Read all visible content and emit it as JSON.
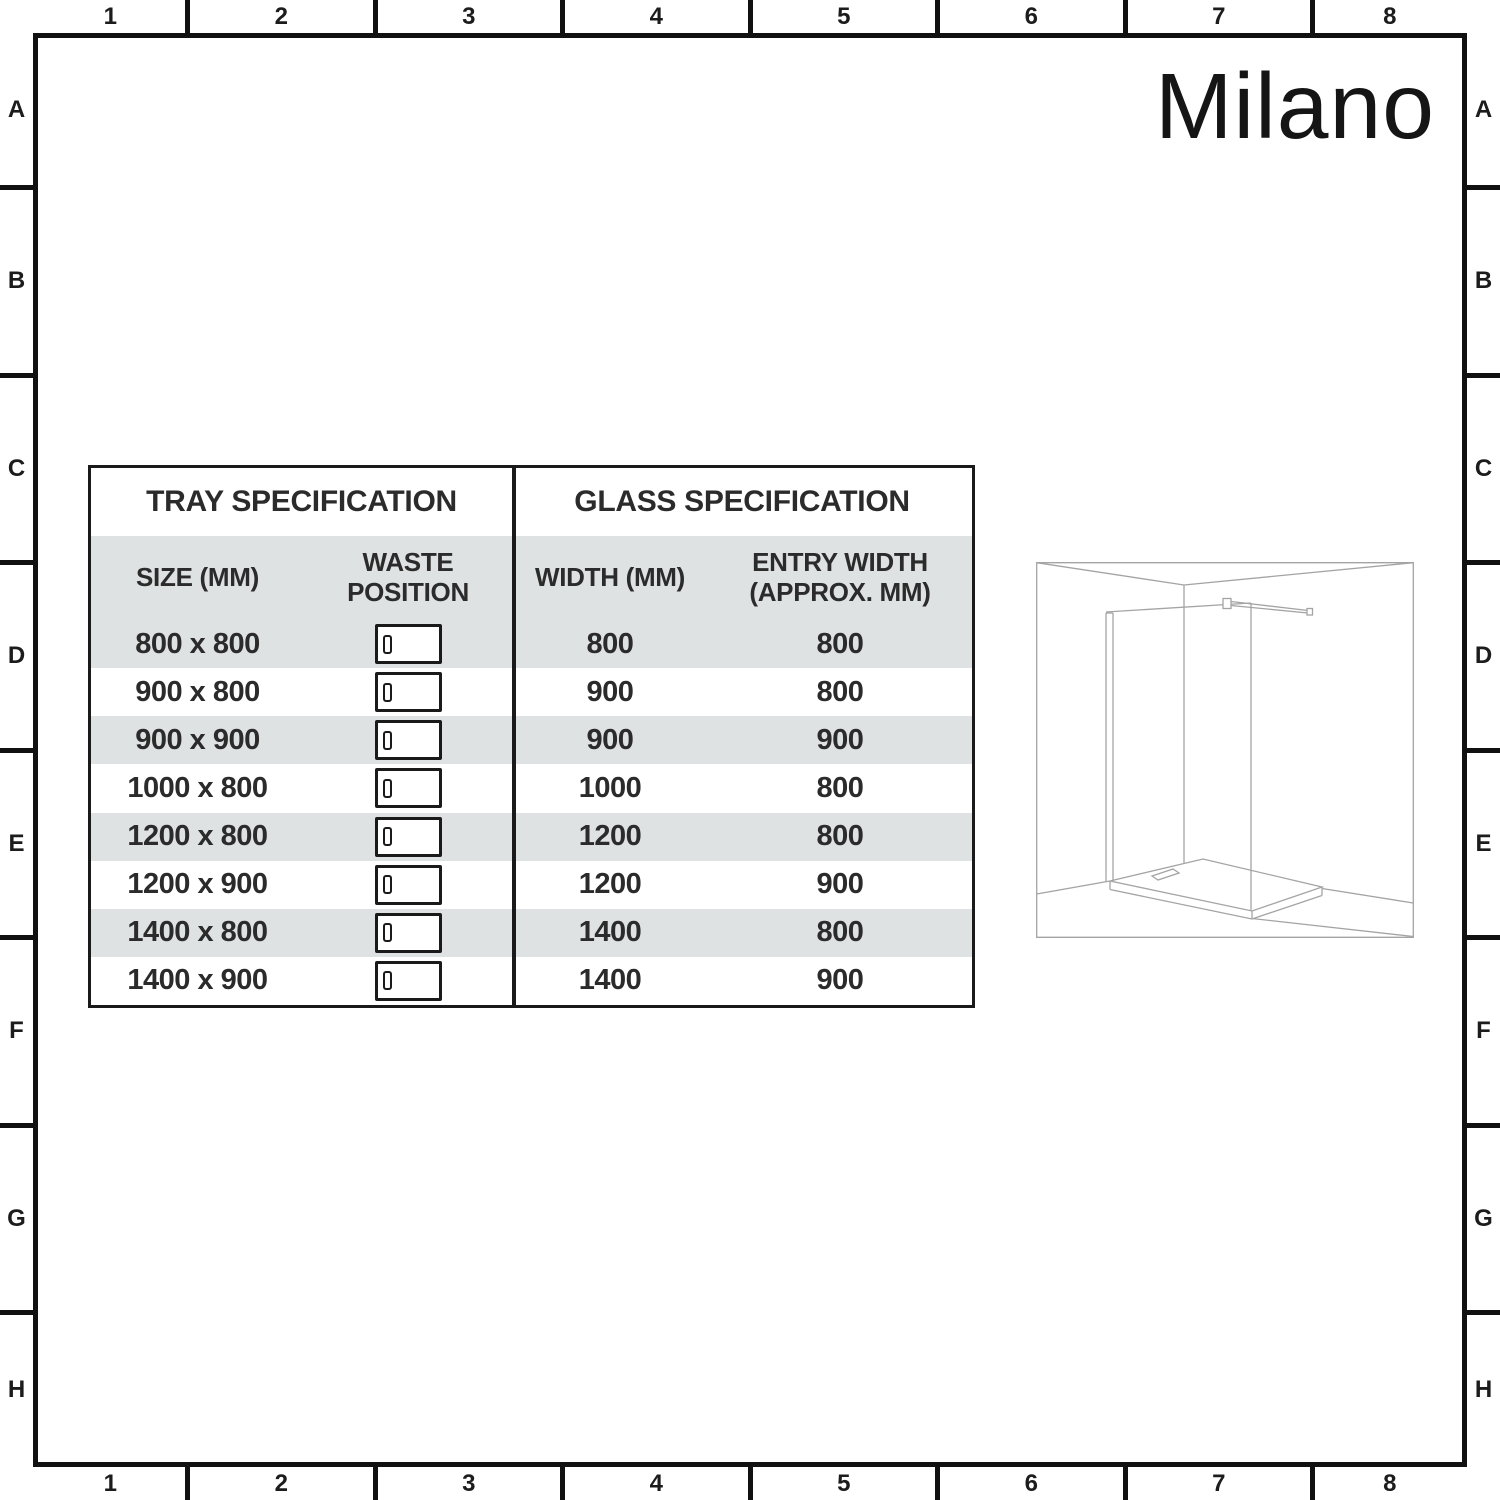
{
  "brand": {
    "logo": "Milano"
  },
  "border": {
    "columns": [
      "1",
      "2",
      "3",
      "4",
      "5",
      "6",
      "7",
      "8"
    ],
    "rows": [
      "A",
      "B",
      "C",
      "D",
      "E",
      "F",
      "G",
      "H"
    ]
  },
  "tables": {
    "tray": {
      "title": "TRAY SPECIFICATION",
      "col_size": "SIZE (MM)",
      "col_waste": "WASTE POSITION",
      "rows": [
        {
          "size": "800 x 800",
          "waste_icon": "tray-waste-position-icon"
        },
        {
          "size": "900 x 800",
          "waste_icon": "tray-waste-position-icon"
        },
        {
          "size": "900 x 900",
          "waste_icon": "tray-waste-position-icon"
        },
        {
          "size": "1000 x 800",
          "waste_icon": "tray-waste-position-icon"
        },
        {
          "size": "1200 x 800",
          "waste_icon": "tray-waste-position-icon"
        },
        {
          "size": "1200 x 900",
          "waste_icon": "tray-waste-position-icon"
        },
        {
          "size": "1400 x 800",
          "waste_icon": "tray-waste-position-icon"
        },
        {
          "size": "1400 x 900",
          "waste_icon": "tray-waste-position-icon"
        }
      ]
    },
    "glass": {
      "title": "GLASS SPECIFICATION",
      "col_width": "WIDTH (MM)",
      "col_entry": "ENTRY WIDTH (APPROX. MM)",
      "rows": [
        {
          "width": "800",
          "entry": "800"
        },
        {
          "width": "900",
          "entry": "800"
        },
        {
          "width": "900",
          "entry": "900"
        },
        {
          "width": "1000",
          "entry": "800"
        },
        {
          "width": "1200",
          "entry": "800"
        },
        {
          "width": "1200",
          "entry": "900"
        },
        {
          "width": "1400",
          "entry": "800"
        },
        {
          "width": "1400",
          "entry": "900"
        }
      ]
    }
  },
  "diagram": {
    "icon": "walk-in-shower-enclosure-diagram"
  },
  "colors": {
    "row_shade": "#dfe2e2",
    "table_border": "#1a1a1a",
    "frame_border": "#111111",
    "line_art": "#a4a4a4",
    "text": "#2b2b2b"
  }
}
